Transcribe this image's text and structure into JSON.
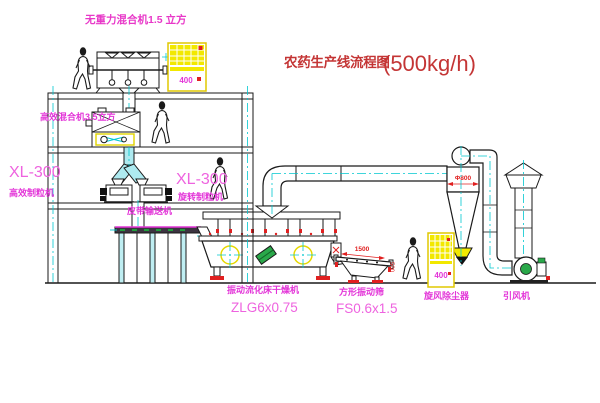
{
  "title": {
    "name": "农药生产线流程图",
    "capacity": "(500kg/h)"
  },
  "labels": {
    "gravity_mixer": "无重力混合机1.5 立方",
    "high_mixer": "高效混合机3.5立方",
    "granulator_left_model": "XL-300",
    "granulator_left_name": "高效制粒机",
    "granulator_right_model": "XL-300",
    "granulator_right_name": "旋转制粒机",
    "belt_conveyor": "皮带输送机",
    "dryer_name": "振动流化床干燥机",
    "dryer_model": "ZLG6x0.75",
    "sieve_name": "方形振动筛",
    "sieve_model": "FS0.6x1.5",
    "cyclone_name": "旋风除尘器",
    "fan_name": "引风机"
  },
  "annotations": {
    "cyclone_diameter": "Φ800",
    "sieve_width_dim": "1500",
    "sieve_side_dim": "500",
    "cabinet_code": "400"
  },
  "colors": {
    "title_red": "#c43535",
    "label_magenta": "#e335d8",
    "centerline_cyan": "#00c8d0",
    "line_black": "#1a1a1a",
    "cabinet_yellow": "#f2e800",
    "motor_green": "#2aa84a",
    "accent_red": "#e02020"
  }
}
